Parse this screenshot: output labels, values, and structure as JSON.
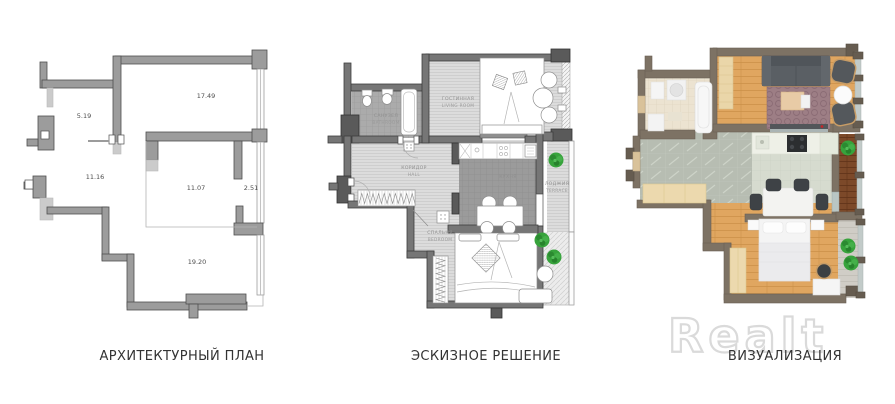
{
  "captions": {
    "architectural": "АРХИТЕКТУРНЫЙ ПЛАН",
    "sketch": "ЭСКИЗНОЕ РЕШЕНИЕ",
    "visualization": "ВИЗУАЛИЗАЦИЯ"
  },
  "watermark": "Realt",
  "architectural_plan": {
    "room_areas": [
      "5.19",
      "17.49",
      "11.16",
      "11.07",
      "2.51",
      "19.20"
    ]
  },
  "sketch_plan": {
    "rooms": [
      {
        "ru": "САНУЗЕЛ",
        "en": "BATHROOM"
      },
      {
        "ru": "ГОСТИННАЯ",
        "en": "LIVING ROOM"
      },
      {
        "ru": "КОРИДОР",
        "en": "HALL"
      },
      {
        "ru": "КУХНЯ",
        "en": "KITCHEN"
      },
      {
        "ru": "ЛОДЖИЯ",
        "en": "TERRACE"
      },
      {
        "ru": "СПАЛЬНЯ",
        "en": "BEDROOM"
      }
    ]
  },
  "colors": {
    "arch_wall": "#9c9c9c",
    "sketch_wall": "#767676",
    "viz_wall": "#7d7264",
    "wood_floor": "#e0a660",
    "plant_green": "#37a33c",
    "watermark_gray": "#dadada"
  }
}
